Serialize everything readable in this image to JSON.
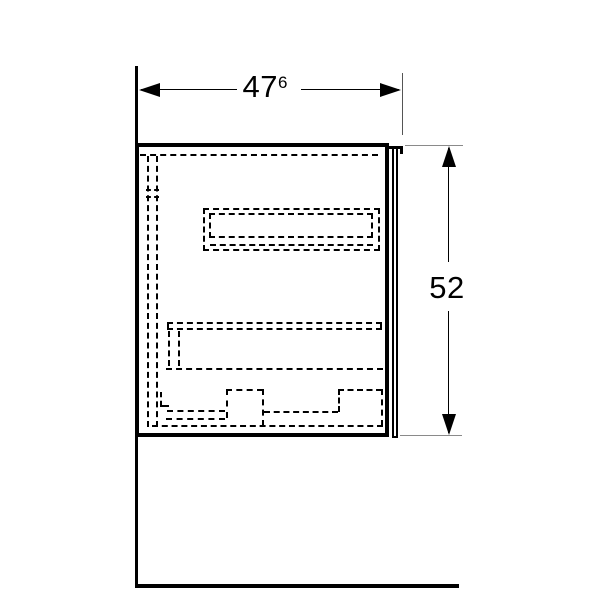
{
  "drawing": {
    "dimensions": {
      "width": {
        "value": "47",
        "superscript": "6"
      },
      "height": {
        "value": "52"
      }
    },
    "colors": {
      "line": "#000000",
      "extension_tick_gray": "#8a8a8a",
      "background": "#ffffff"
    }
  }
}
